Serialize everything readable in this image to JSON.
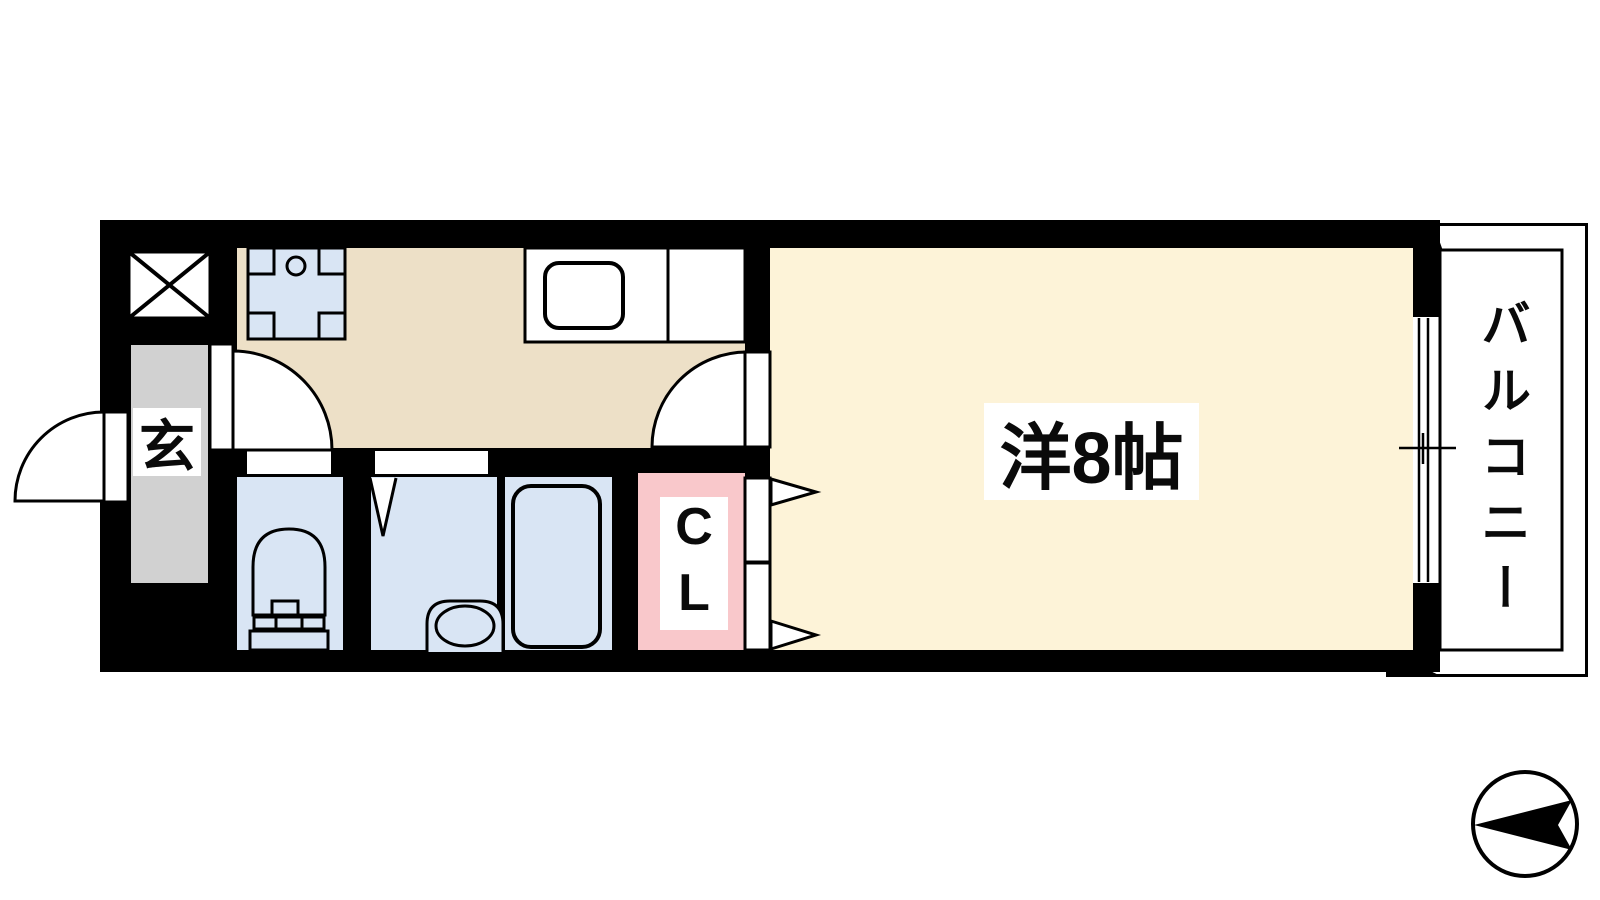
{
  "labels": {
    "entrance": "玄",
    "closet": "CL",
    "main_room": "洋8帖",
    "balcony": "バルコニー"
  },
  "colors": {
    "wall": "#000000",
    "kitchen_floor": "#EDE0C7",
    "main_room_floor": "#FDF3D8",
    "entrance_floor": "#D1D1D1",
    "wet_area_floor": "#D9E5F4",
    "closet_floor": "#F9C8CB",
    "balcony": "#FFFFFF"
  },
  "compass": {
    "direction": "left"
  }
}
